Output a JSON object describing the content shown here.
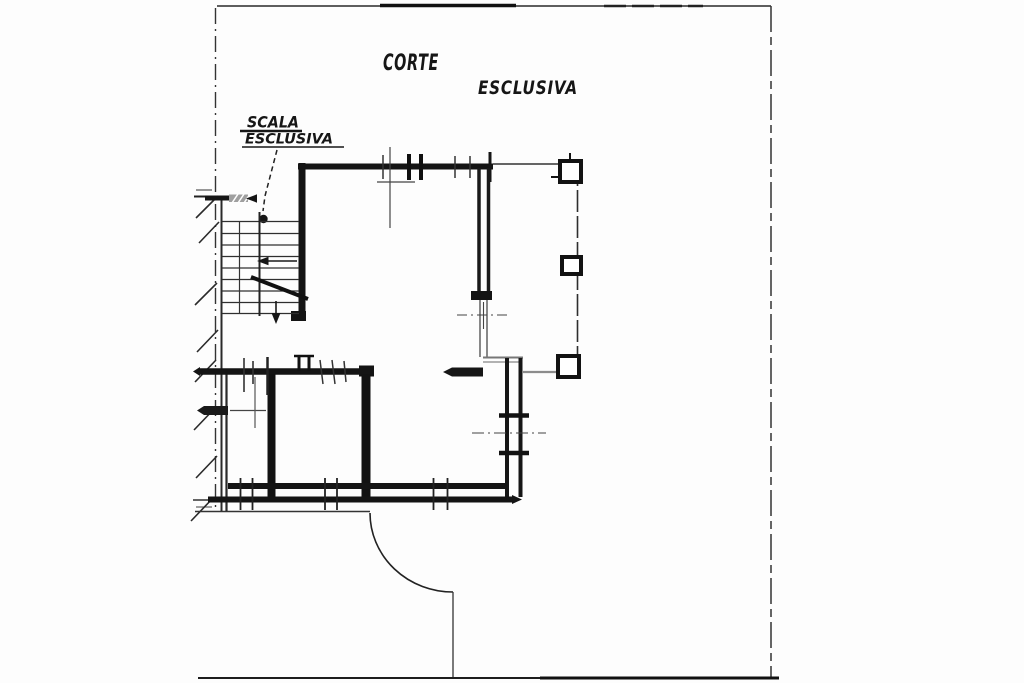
{
  "labels": {
    "courtyard_word1": "CORTE",
    "courtyard_word2": "ESCLUSIVA",
    "staircase_word1": "SCALA",
    "staircase_word2": "ESCLUSIVA"
  },
  "colors": {
    "ink": "#161616",
    "line_gray": "#8c8c8c",
    "paper": "#fdfdfd"
  }
}
